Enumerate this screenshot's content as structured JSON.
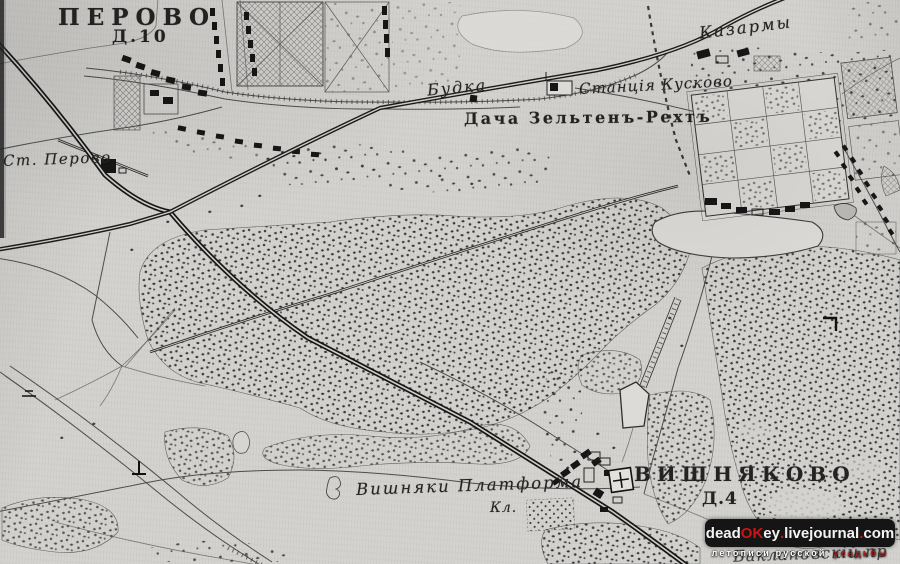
{
  "map": {
    "labels": {
      "perovo_title": "ПЕРОВО",
      "perovo_sub": "Д.10",
      "st_perovo": "Ст. Перово",
      "budka": "Будка",
      "station_kuskovo": "Станція Кусково",
      "dacha": "Дача Зельтенъ-Рехтъ",
      "kazarmy": "Казармы",
      "vishnyaki_platforma": "Вишняки Платформа",
      "kl": "Кл.",
      "vishnyakovo_title": "ВИШНЯКОВО",
      "vishnyakovo_sub": "Д.4",
      "baklanovsky": "Баклановскій пр"
    },
    "colors": {
      "paper": "#d3d2cf",
      "ink": "#1c1c1c",
      "road": "#4c4c4c"
    }
  },
  "watermark": {
    "site": {
      "p1": "dead",
      "p2": "OK",
      "p3": "ey",
      "d1": ".",
      "p4": "livejournal",
      "d2": ".",
      "p5": "com"
    },
    "tagline": {
      "t1": "летописи русской",
      "t2": "усадьбы"
    },
    "colors": {
      "badge_bg": "#151515",
      "accent_red": "#cf1212",
      "text": "#f3f3f3"
    }
  }
}
